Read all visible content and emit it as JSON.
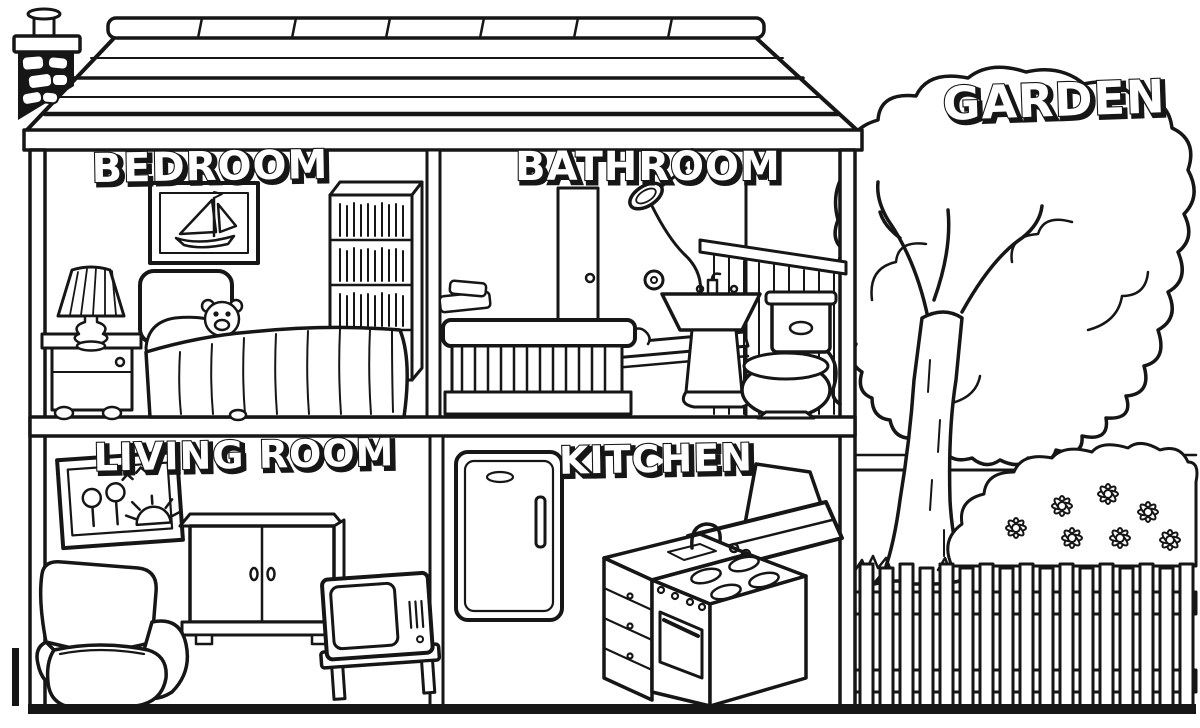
{
  "ink_color": "#161616",
  "paper_color": "#ffffff",
  "house": {
    "rooms": [
      {
        "id": "bedroom",
        "label": "BEDROOM",
        "items": [
          "framed-sailboat-picture",
          "bookshelf",
          "bed",
          "teddy-bear",
          "nightstand",
          "table-lamp"
        ]
      },
      {
        "id": "bathroom",
        "label": "BATHROOM",
        "items": [
          "shower",
          "bathtub",
          "towels",
          "pedestal-sink",
          "toilet",
          "toilet-paper-roll",
          "wall-paneling"
        ]
      },
      {
        "id": "living_room",
        "label": "LIVING ROOM",
        "items": [
          "framed-flower-picture",
          "cabinet",
          "armchair",
          "television",
          "tv-stand"
        ]
      },
      {
        "id": "kitchen",
        "label": "KITCHEN",
        "items": [
          "refrigerator",
          "extractor-hood",
          "sink-counter",
          "stove-oven"
        ]
      }
    ],
    "structure": [
      "roof",
      "chimney",
      "walls",
      "floors"
    ]
  },
  "garden": {
    "label": "GARDEN",
    "items": [
      "tree",
      "flower-bush",
      "daisies",
      "picket-fence",
      "grass",
      "horizon"
    ]
  }
}
